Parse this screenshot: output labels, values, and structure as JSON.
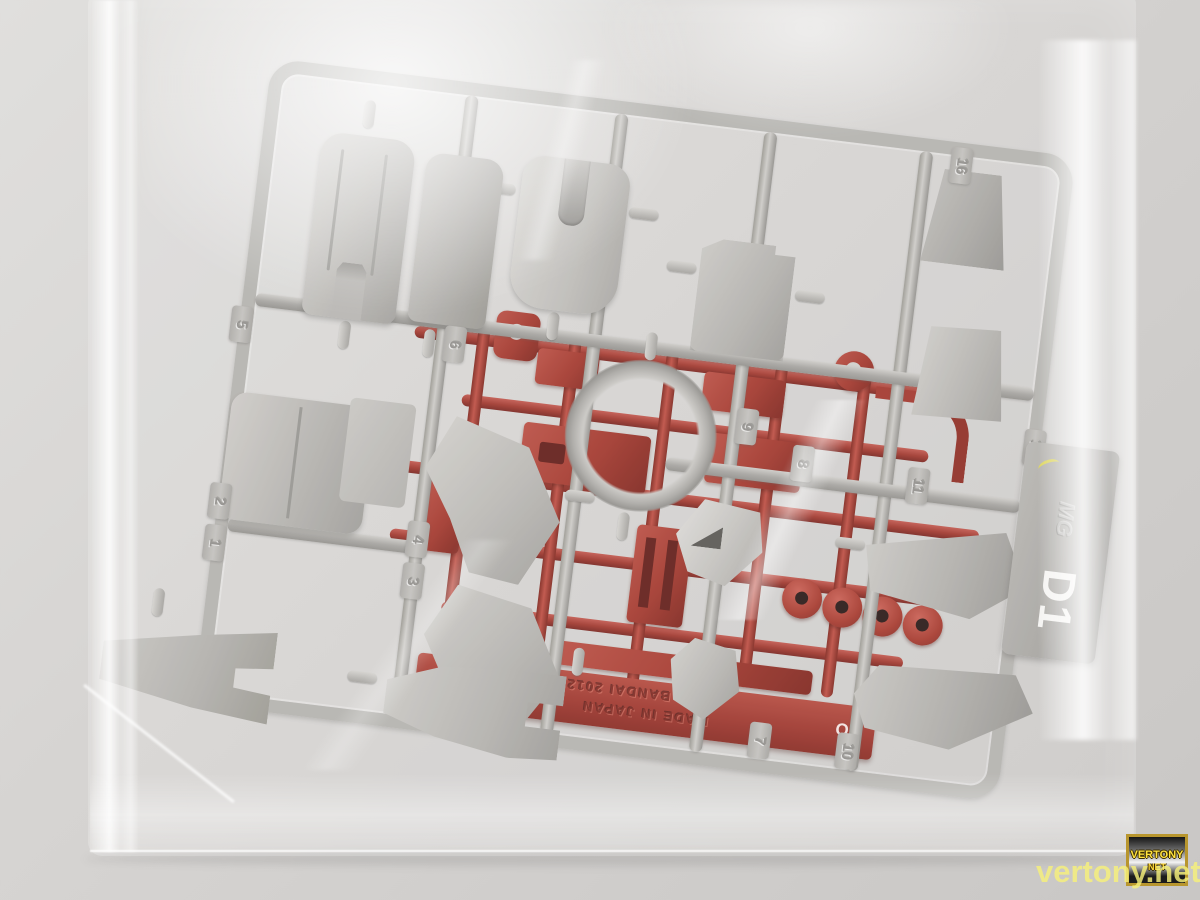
{
  "scene": {
    "description": "Clear plastic bag containing a gray Bandai MG model-kit runner (D1) stacked over a red runner (C1) against a plain light wall",
    "colors": {
      "wall": "#d6d4d2",
      "gray_plastic": "#b5b3af",
      "red_plastic": "#a33428",
      "watermark_yellow": "#f6f07a",
      "badge_gold": "#b8962e"
    }
  },
  "runners": {
    "front": {
      "id": "D1",
      "brand_logo": "MG",
      "part_numbers": [
        "1",
        "2",
        "3",
        "4",
        "5",
        "6",
        "7",
        "8",
        "9",
        "10",
        "11",
        "12",
        "16"
      ]
    },
    "back": {
      "id": "C1",
      "embossed_line1": "BAN BANDAI 2012",
      "embossed_line2": "MADE IN JAPAN",
      "mark": "O"
    }
  },
  "watermark": {
    "site_text": "vertony.net",
    "badge_line1": "VERTONY",
    "badge_line2": "NET"
  }
}
